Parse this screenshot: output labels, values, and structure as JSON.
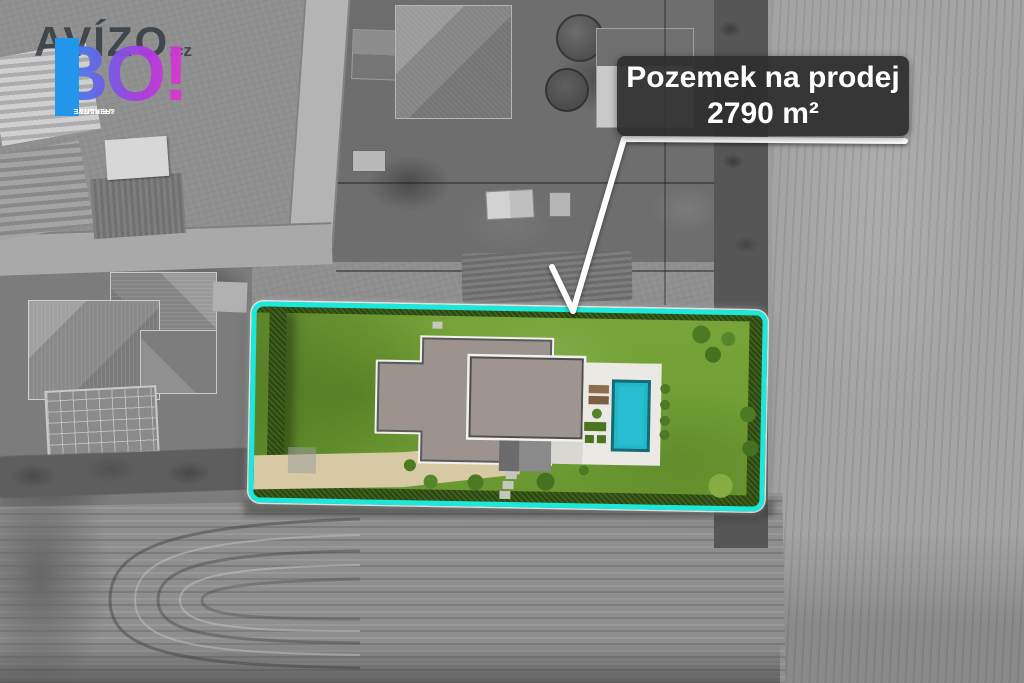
{
  "overlay": {
    "label": {
      "line1": "Pozemek na prodej",
      "line2": "2790 m²"
    },
    "logo": {
      "brand": "AVÍZO",
      "suffix": ".cz",
      "accent": "BO!",
      "tagline1": "REALITY",
      "tagline2": "& FINANCE"
    }
  },
  "plot": {
    "area_text": "2790 m²",
    "outline_color": "#19e8da",
    "grass_color": "#73a238",
    "hedge_color": "#3d5f1b",
    "roof_left_color": "#9c928e",
    "roof_right_color": "#9e9591",
    "terrace_color": "#ebe9e4",
    "pool_color": "#22b6c9",
    "driveway_color": "#d7c9a4"
  },
  "annotation": {
    "arrow_color": "#ffffff",
    "label_background": "rgba(45,45,45,0.92)",
    "label_text_color": "#ffffff",
    "logo_gradient_start": "#1f97ef",
    "logo_gradient_end": "#e337c8",
    "tagline_box_color": "#2196ea"
  }
}
